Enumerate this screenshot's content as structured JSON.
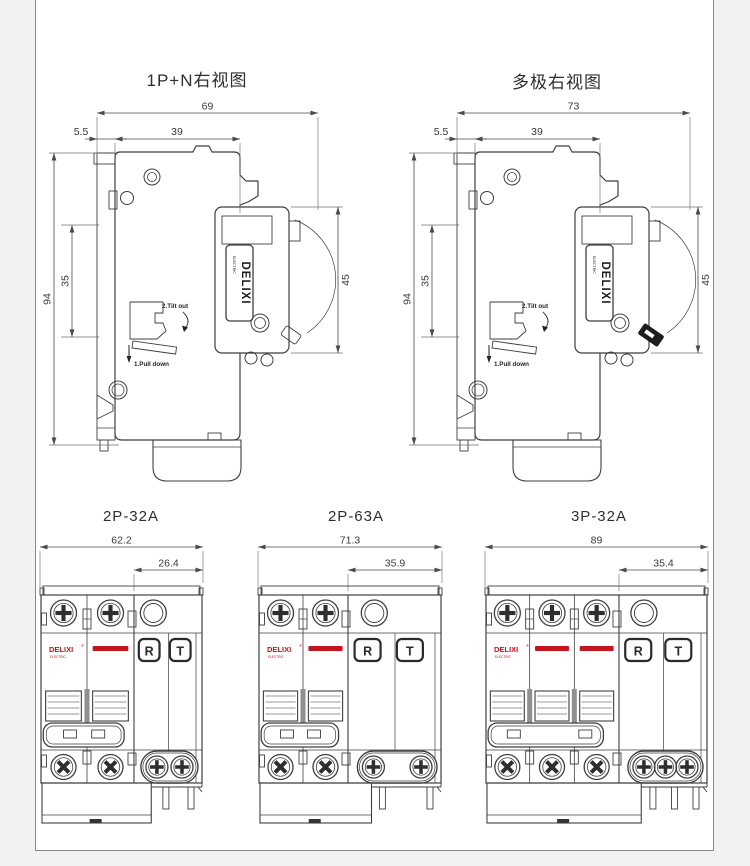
{
  "colors": {
    "background": "#f2f2f4",
    "canvas": "#ffffff",
    "line": "#3f3f3f",
    "dim": "#4a4a4a",
    "accent_red": "#c3161c",
    "dark_fill": "#1d1d1d"
  },
  "side_views": [
    {
      "title": "1P+N右视图",
      "dim_width_total": "69",
      "dim_front_offset": "5.5",
      "dim_body_depth": "39",
      "dim_height": "94",
      "dim_rail_window": "35",
      "dim_module_height": "45",
      "anno_tilt": "2.Tilt out",
      "anno_pull": "1.Pull down",
      "brand": "DELIXI",
      "brand_sub": "ELECTRIC"
    },
    {
      "title": "多极右视图",
      "dim_width_total": "73",
      "dim_front_offset": "5.5",
      "dim_body_depth": "39",
      "dim_height": "94",
      "dim_rail_window": "35",
      "dim_module_height": "45",
      "anno_tilt": "2.Tilt out",
      "anno_pull": "1.Pull down",
      "brand": "DELIXI",
      "brand_sub": "ELECTRIC"
    }
  ],
  "front_views": [
    {
      "title": "2P-32A",
      "dim_total_width": "62.2",
      "dim_module_width": "26.4",
      "poles": 2,
      "brand": "DELIXI",
      "brand_reg": "®",
      "brand_sub": "ELECTRIC",
      "reset_button": "R",
      "test_button": "T"
    },
    {
      "title": "2P-63A",
      "dim_total_width": "71.3",
      "dim_module_width": "35.9",
      "poles": 2,
      "brand": "DELIXI",
      "brand_reg": "®",
      "brand_sub": "ELECTRIC",
      "reset_button": "R",
      "test_button": "T"
    },
    {
      "title": "3P-32A",
      "dim_total_width": "89",
      "dim_module_width": "35.4",
      "poles": 3,
      "brand": "DELIXI",
      "brand_reg": "®",
      "brand_sub": "ELECTRIC",
      "reset_button": "R",
      "test_button": "T"
    }
  ]
}
